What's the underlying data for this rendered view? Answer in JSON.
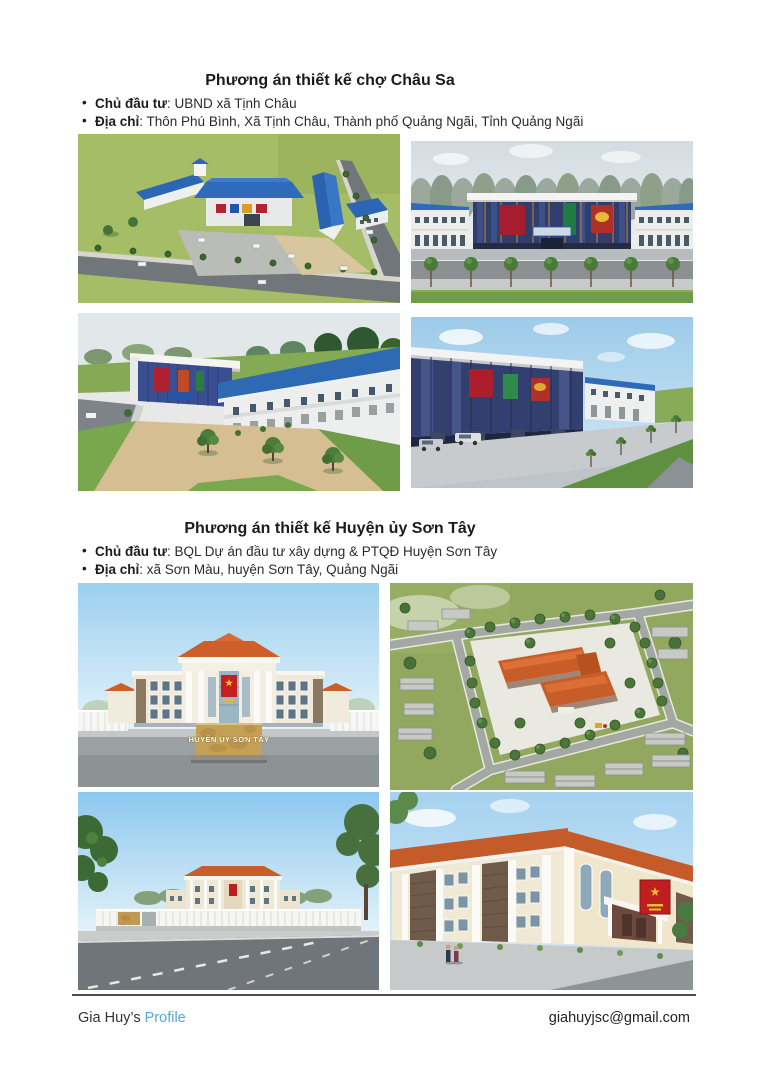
{
  "document": {
    "sections": [
      {
        "title": "Phương án thiết kế chợ Châu Sa",
        "bullets": [
          {
            "label": "Chủ đầu tư",
            "text": ": UBND xã Tịnh Châu"
          },
          {
            "label": "Địa chỉ",
            "text": ": Thôn Phú Bình, Xã Tịnh Châu, Thành phố Quảng Ngãi, Tỉnh Quảng Ngãi"
          }
        ],
        "images": [
          {
            "name": "market-aerial-overview-render"
          },
          {
            "name": "market-front-elevation-render"
          },
          {
            "name": "market-plaza-perspective-render"
          },
          {
            "name": "market-street-perspective-render"
          }
        ]
      },
      {
        "title": "Phương án thiết kế Huyện ủy Sơn Tây",
        "bullets": [
          {
            "label": "Chủ đầu tư",
            "text": ": BQL Dự án đầu tư xây dựng & PTQĐ Huyện Sơn Tây"
          },
          {
            "label": "Địa chỉ",
            "text": ": xã Sơn Màu, huyện Sơn Tây, Quảng Ngãi"
          }
        ],
        "building_sign_text": "HUYỆN ỦY SƠN TÂY",
        "images": [
          {
            "name": "office-front-view-render"
          },
          {
            "name": "office-aerial-compound-render"
          },
          {
            "name": "office-street-distance-render"
          },
          {
            "name": "office-corner-perspective-render"
          }
        ]
      }
    ],
    "footer": {
      "owner_text": "Gia Huy’s ",
      "profile_link": "Profile",
      "email": "giahuyjsc@gmail.com"
    },
    "colors": {
      "link_blue": "#54a8da",
      "market_roof_blue": "#2e6bb8",
      "office_roof_orange": "#cc5e2a",
      "party_banner_red": "#c02020",
      "sign_marble_gold": "#c59f55",
      "footer_rule_gray": "#4d4d4d"
    }
  }
}
